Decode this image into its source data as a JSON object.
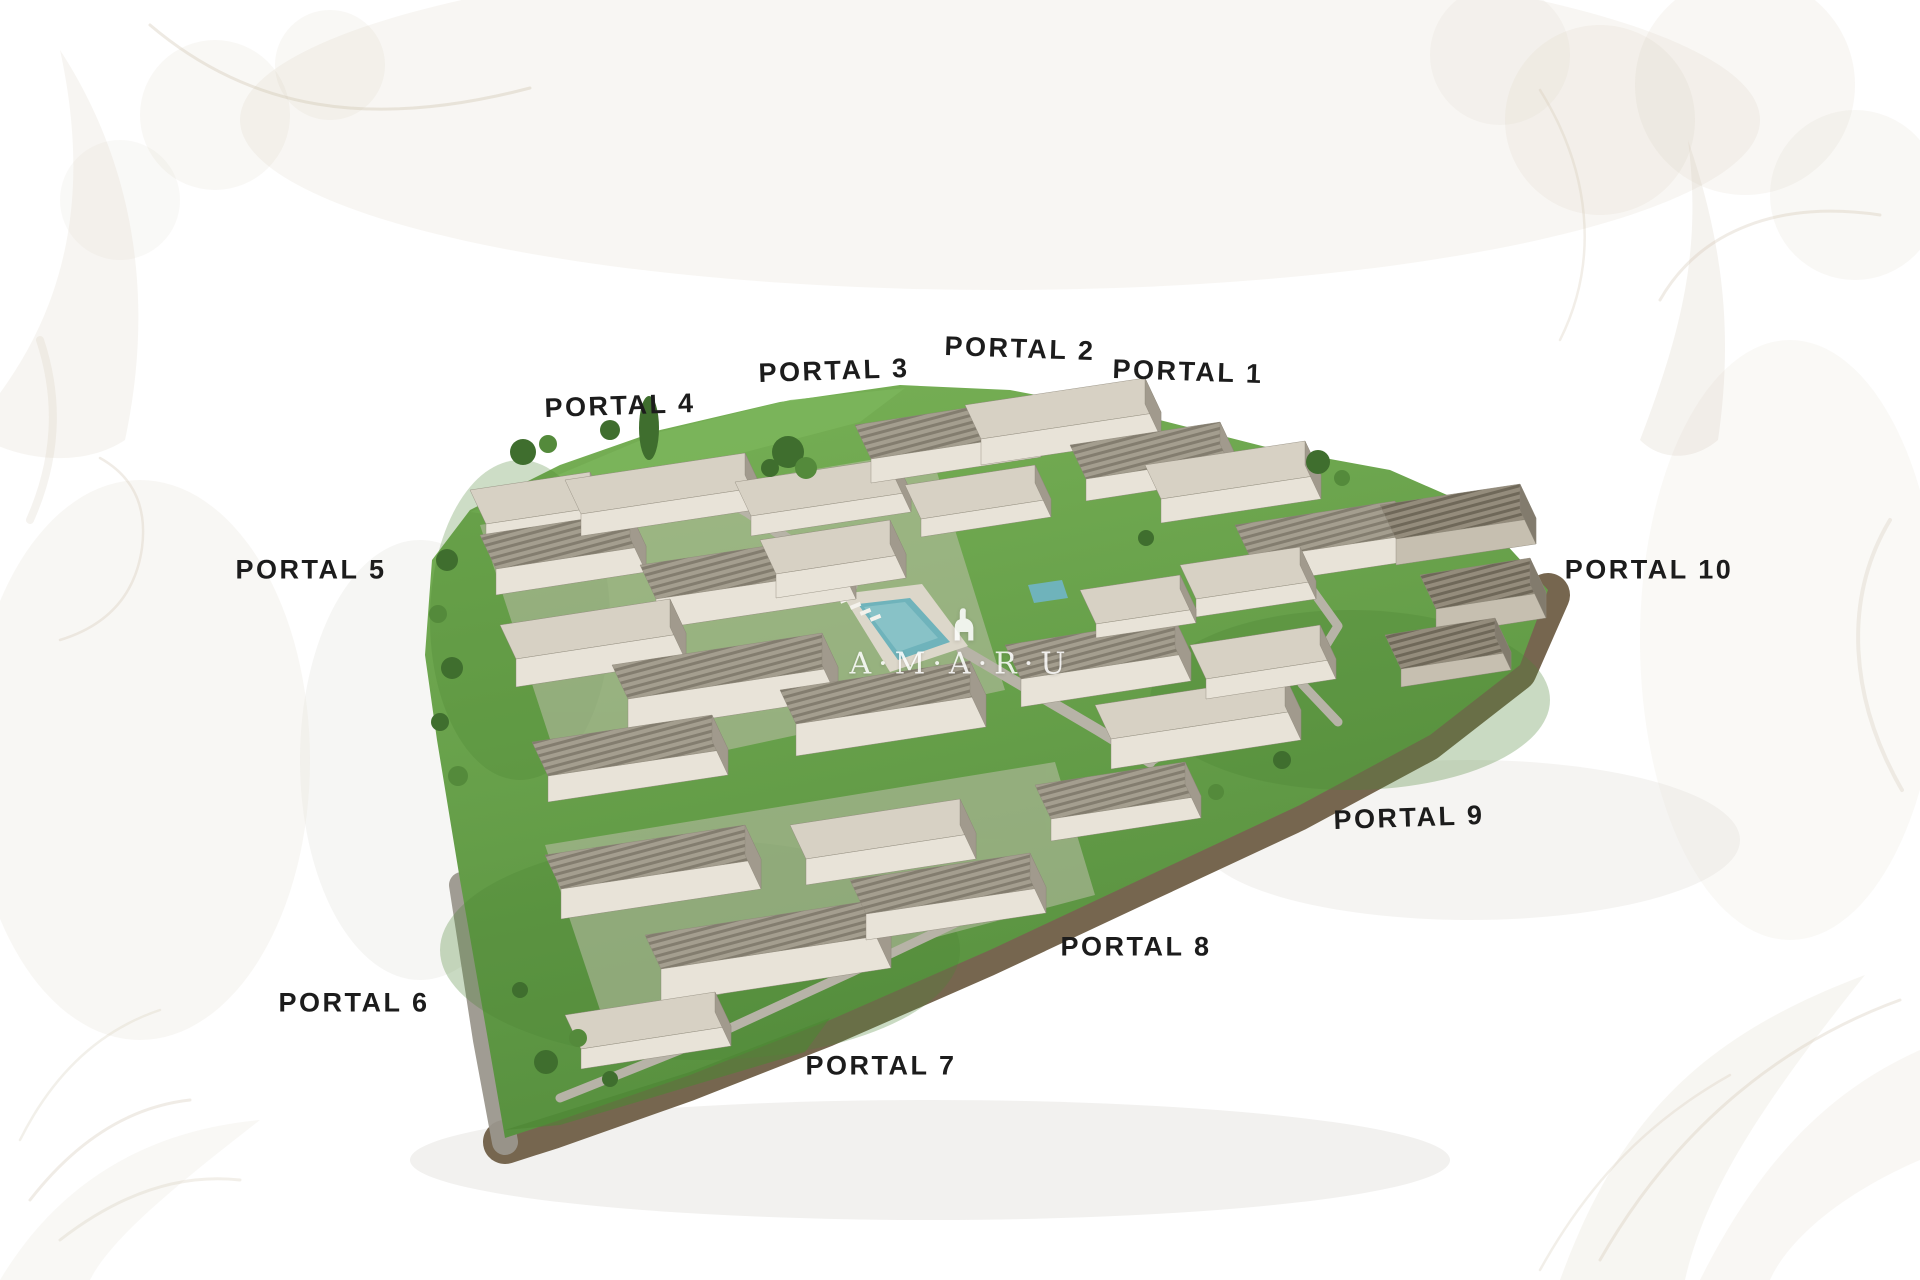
{
  "watermark": {
    "letters": "A·M·A·R·U",
    "logo_icon": "amaru-figure-icon"
  },
  "portals": [
    {
      "id": 1,
      "text": "PORTAL 1"
    },
    {
      "id": 2,
      "text": "PORTAL 2"
    },
    {
      "id": 3,
      "text": "PORTAL 3"
    },
    {
      "id": 4,
      "text": "PORTAL 4"
    },
    {
      "id": 5,
      "text": "PORTAL 5"
    },
    {
      "id": 6,
      "text": "PORTAL 6"
    },
    {
      "id": 7,
      "text": "PORTAL 7"
    },
    {
      "id": 8,
      "text": "PORTAL 8"
    },
    {
      "id": 9,
      "text": "PORTAL 9"
    },
    {
      "id": 10,
      "text": "PORTAL 10"
    }
  ],
  "palette": {
    "label": "#1c1c1c",
    "watermark": "#ffffff",
    "grass": "#65a149",
    "grass-light": "#7cb75c",
    "grass-dark": "#4d8634",
    "tree": "#3f6e2e",
    "roof": "#d7d1c4",
    "face": "#e8e3d8",
    "side": "#a19a8d",
    "path": "#b7b3a7",
    "dirt": "#6f5e46",
    "wall": "#9b978d",
    "pool": "#6fb3bb",
    "pool-light": "#9ccdd2",
    "deck": "#dcd7ca",
    "decor": "#c9bba3"
  }
}
